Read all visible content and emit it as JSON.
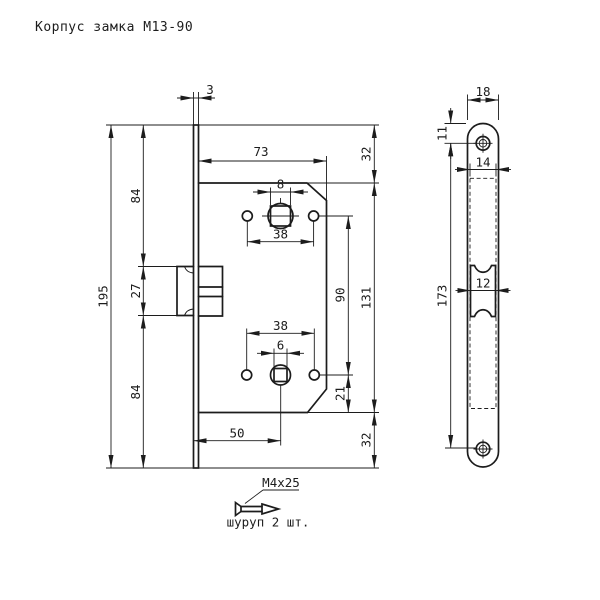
{
  "title": "Корпус замка М13-90",
  "colors": {
    "line": "#1c1c1c",
    "background": "#ffffff"
  },
  "main_view": {
    "dim_faceplate_thickness": "3",
    "dim_body_width": "73",
    "dim_top_margin": "32",
    "dim_body_height": "131",
    "dim_bottom_margin": "32",
    "dim_hub_distance": "90",
    "dim_hub_to_bottom": "21",
    "dim_top_to_latch": "84",
    "dim_latch_height": "27",
    "dim_latch_to_bottom": "84",
    "dim_faceplate_length": "195",
    "dim_upper_square_hole": "8",
    "dim_upper_hole_spacing": "38",
    "dim_lower_hole_spacing": "38",
    "dim_lower_square_hole": "6",
    "dim_backset": "50"
  },
  "side_view": {
    "dim_faceplate_width": "18",
    "dim_screw_hole_offset": "11",
    "dim_cutout_width": "14",
    "dim_latch_width": "12",
    "dim_screw_hole_spacing": "173"
  },
  "screw_note": {
    "size_label": "М4х25",
    "caption": "шуруп 2 шт."
  }
}
